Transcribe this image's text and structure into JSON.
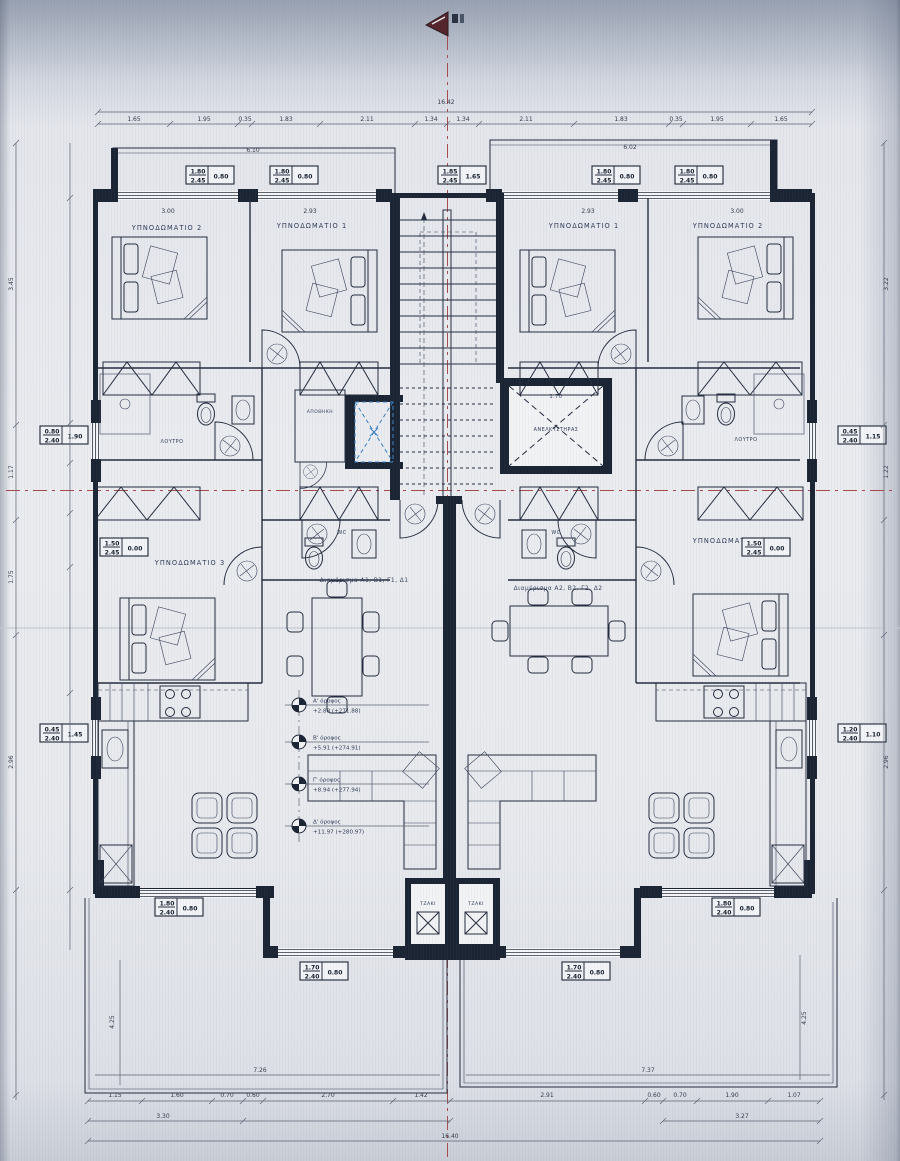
{
  "rooms": {
    "bedroom2_left": "ΥΠΝΟΔΩΜΑΤΙΟ 2",
    "bedroom1_left": "ΥΠΝΟΔΩΜΑΤΙΟ 1",
    "bedroom1_right": "ΥΠΝΟΔΩΜΑΤΙΟ 1",
    "bedroom2_right": "ΥΠΝΟΔΩΜΑΤΙΟ 2",
    "bedroom3_left": "ΥΠΝΟΔΩΜΑΤΙΟ 3",
    "bedroom3_right": "ΥΠΝΟΔΩΜΑΤΙΟ 3",
    "bath_left": "ΛΟΥΤΡΟ",
    "bath_right": "ΛΟΥΤΡΟ",
    "wc_left": "WC",
    "wc_right": "WC",
    "storage": "ΑΠΟΘΗΚΗ",
    "elevator": "ΑΝΕΛΚΥΣΤΗΡΑΣ",
    "fireplace_left": "ΤΖΑΚΙ",
    "fireplace_right": "ΤΖΑΚΙ"
  },
  "apartments": {
    "left": "Διαμέρισμα Α1, Β1, Γ1, Δ1",
    "right": "Διαμέρισμα Α2, Β2, Γ2, Δ2"
  },
  "levels": [
    {
      "name": "Α' όροφος",
      "elev": "+2.88 (+271.88)"
    },
    {
      "name": "Β' όροφος",
      "elev": "+5.91 (+274.91)"
    },
    {
      "name": "Γ' όροφος",
      "elev": "+8.94 (+277.94)"
    },
    {
      "name": "Δ' όροφος",
      "elev": "+11.97 (+280.97)"
    }
  ],
  "window_tags": [
    {
      "w": "1.80",
      "h": "2.45",
      "sill": "0.80"
    },
    {
      "w": "1.80",
      "h": "2.45",
      "sill": "0.80"
    },
    {
      "w": "1.85",
      "h": "2.45",
      "sill": "1.65"
    },
    {
      "w": "1.80",
      "h": "2.45",
      "sill": "0.80"
    },
    {
      "w": "1.80",
      "h": "2.45",
      "sill": "0.80"
    },
    {
      "w": "0.80",
      "h": "2.40",
      "sill": "1.90"
    },
    {
      "w": "0.45",
      "h": "2.40",
      "sill": "1.15"
    },
    {
      "w": "0.45",
      "h": "2.40",
      "sill": "1.45"
    },
    {
      "w": "1.20",
      "h": "2.40",
      "sill": "1.10"
    },
    {
      "w": "1.50",
      "h": "2.45",
      "sill": "0.00"
    },
    {
      "w": "1.50",
      "h": "2.45",
      "sill": "0.00"
    },
    {
      "w": "1.80",
      "h": "2.40",
      "sill": "0.80"
    },
    {
      "w": "1.80",
      "h": "2.40",
      "sill": "0.80"
    },
    {
      "w": "1.70",
      "h": "2.40",
      "sill": "0.80"
    },
    {
      "w": "1.70",
      "h": "2.40",
      "sill": "0.80"
    }
  ],
  "dims": {
    "top_overall": "16.42",
    "top": [
      "1.65",
      "1.95",
      "0.35",
      "1.83",
      "2.11",
      "1.34",
      "1.34",
      "2.11",
      "1.83",
      "0.35",
      "1.95",
      "1.65"
    ],
    "bottom": [
      "1.15",
      "1.60",
      "0.70",
      "0.60",
      "2.70",
      "1.42",
      "2.91",
      "0.60",
      "0.70",
      "1.90",
      "1.07"
    ],
    "bottom_left2": "3.30",
    "bottom_right2": "3.27",
    "bottom_overall": "16.40",
    "left": [
      "3.45",
      "1.17",
      "1.75",
      "2.96"
    ],
    "right": [
      "3.22",
      "1.22",
      "2.96"
    ],
    "room_widths": [
      "3.00",
      "2.93",
      "2.93",
      "3.00"
    ],
    "balcony_left": "6.10",
    "balcony_right": "6.02",
    "terrace_height_left": "4.25",
    "terrace_height_right": "4.25",
    "terrace_width_left": "7.26",
    "terrace_width_right": "7.37",
    "elevator_width": "1.70"
  },
  "colors": {
    "ink": "#1b2433",
    "axis_red": "#a84a4a",
    "skylight_blue": "#3b82c4",
    "paper": "#e9ebef"
  }
}
